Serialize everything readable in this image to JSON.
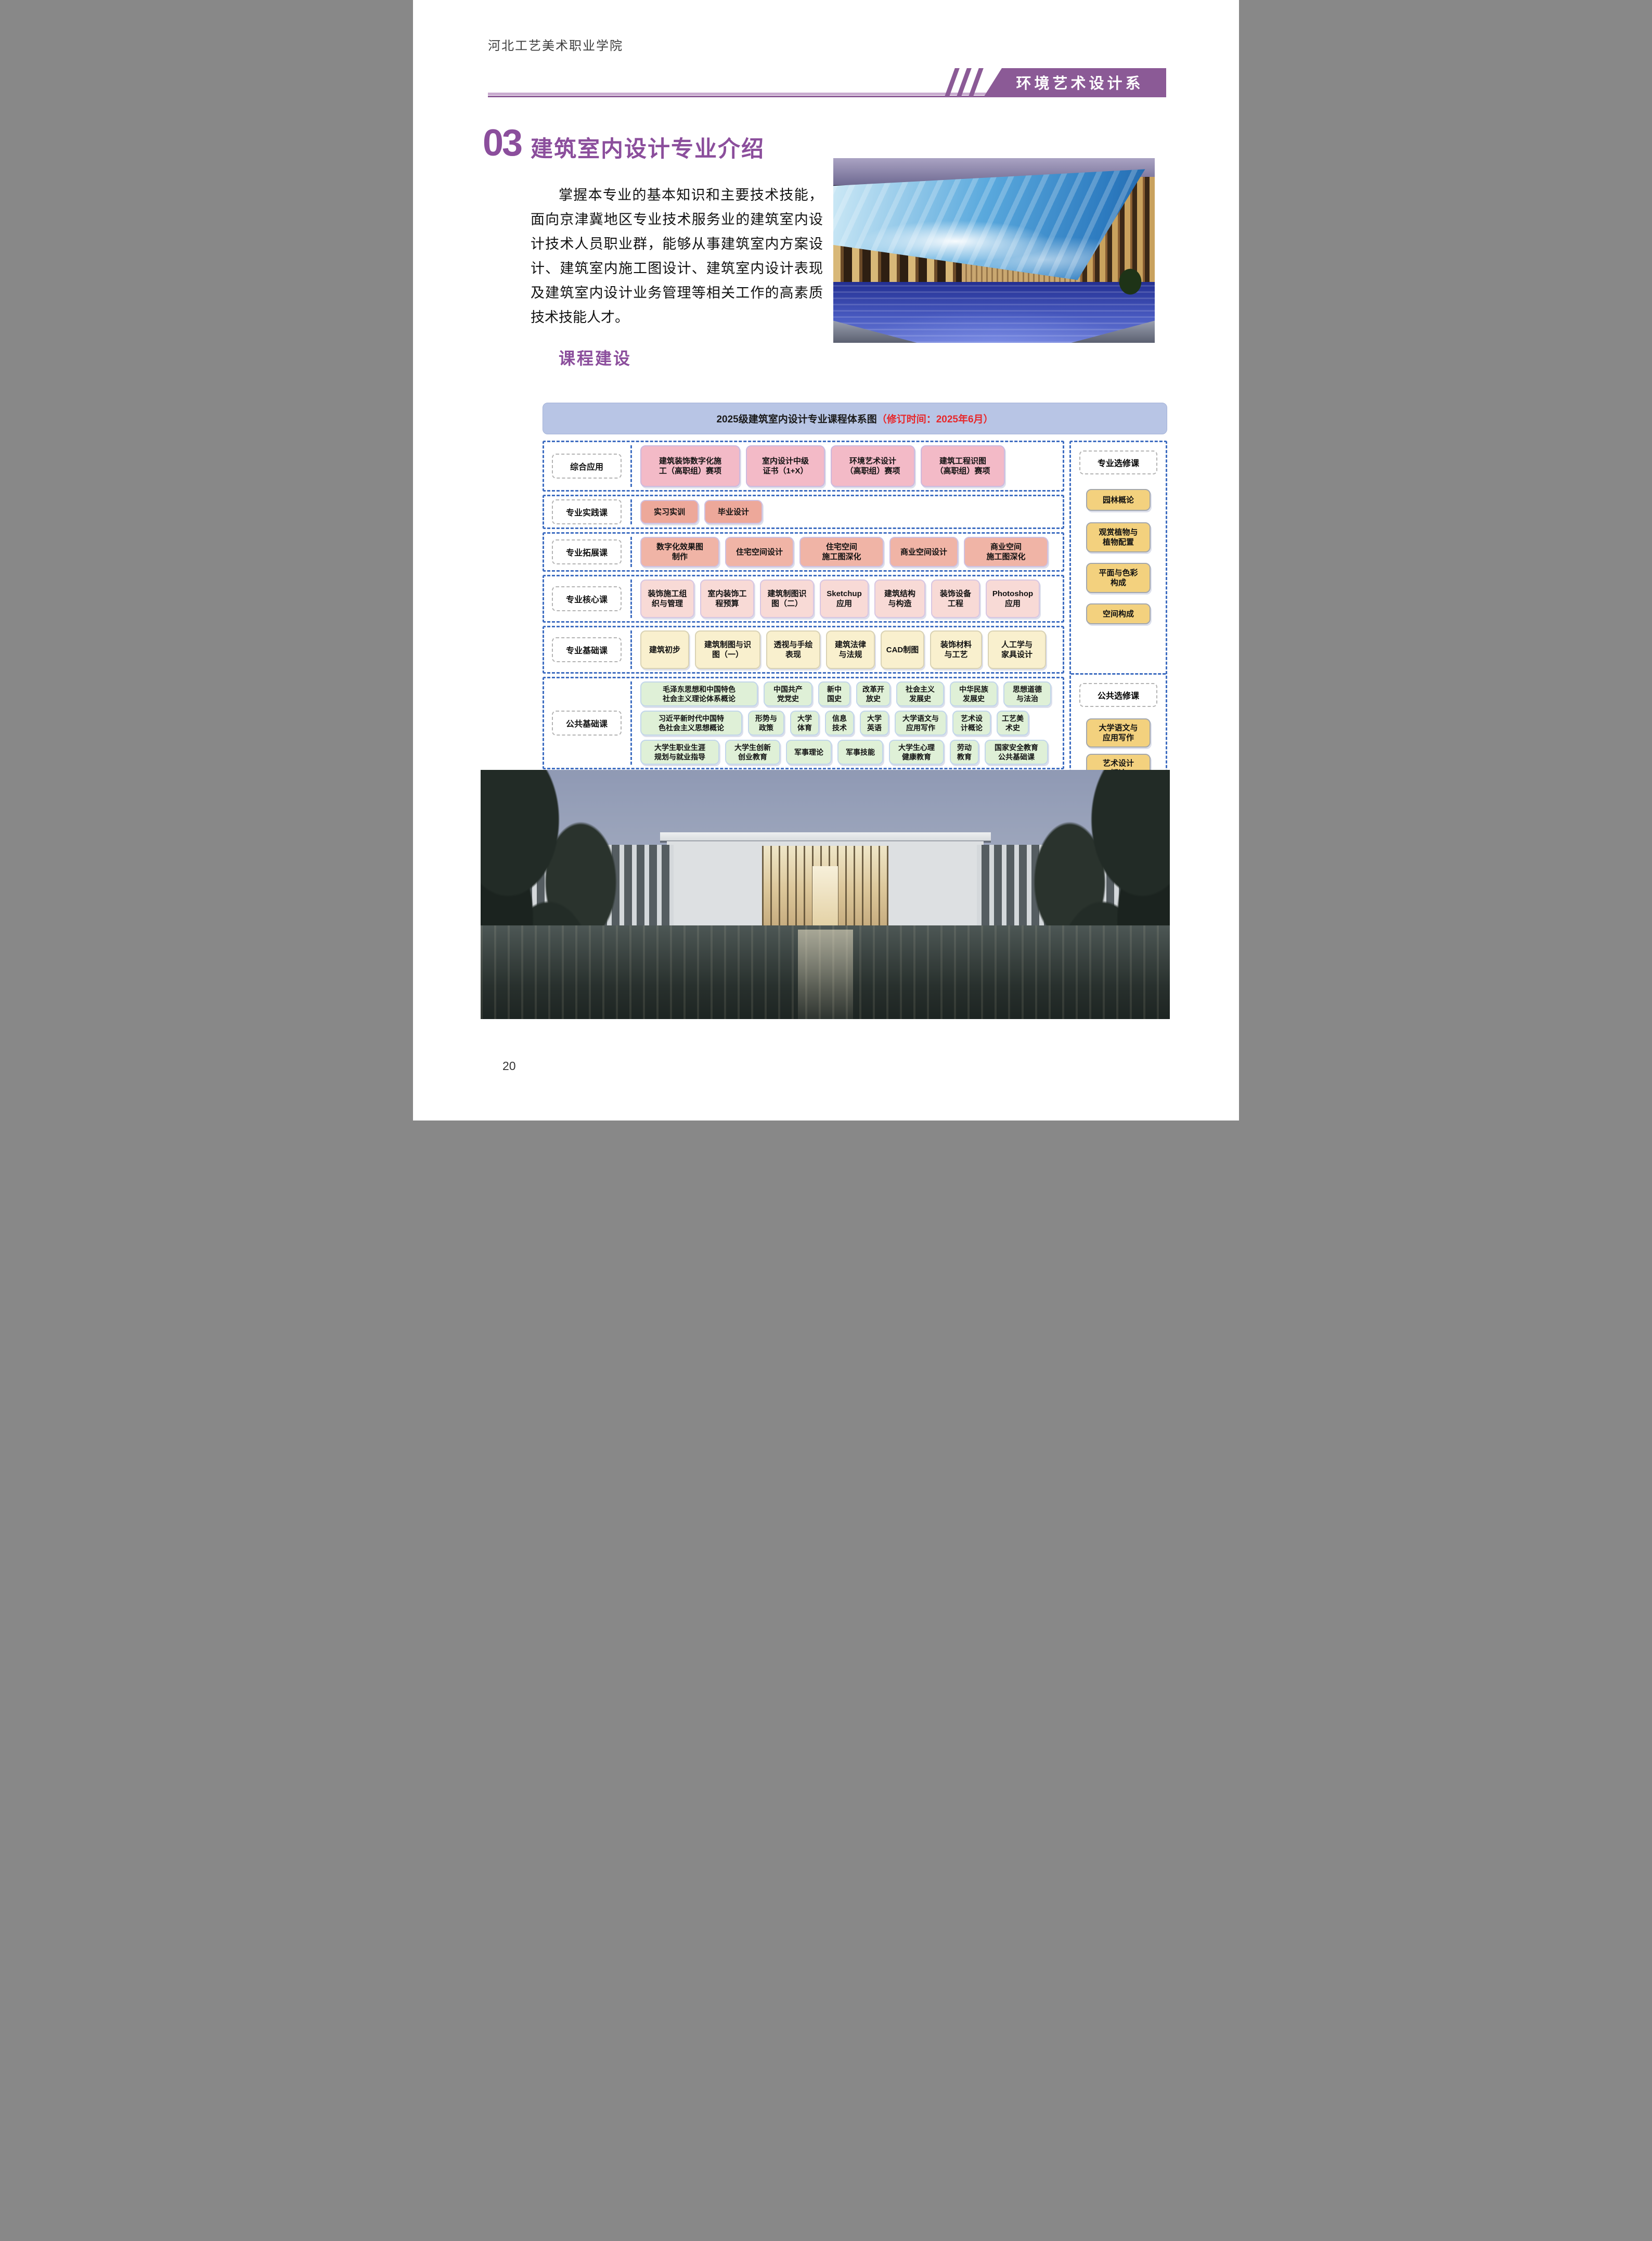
{
  "page": {
    "school_name": "河北工艺美术职业学院",
    "department": "环境艺术设计系",
    "section_number": "03",
    "section_title": "建筑室内设计专业介绍",
    "intro_paragraph": "掌握本专业的基本知识和主要技术技能，面向京津冀地区专业技术服务业的建筑室内设计技术人员职业群，能够从事建筑室内方案设计、建筑室内施工图设计、建筑室内设计表现及建筑室内设计业务管理等相关工作的高素质技术技能人才。",
    "subsection_title": "课程建设",
    "page_number": "20"
  },
  "diagram": {
    "title": "2025级建筑室内设计专业课程体系图",
    "title_note": "（修订时间：2025年6月）",
    "rows": [
      {
        "label": "综合应用",
        "boxes": [
          "建筑装饰数字化施\n工（高职组）赛项",
          "室内设计中级\n证书（1+X）",
          "环境艺术设计\n（高职组）赛项",
          "建筑工程识图\n（高职组）赛项"
        ]
      },
      {
        "label": "专业实践课",
        "boxes": [
          "实习实训",
          "毕业设计"
        ]
      },
      {
        "label": "专业拓展课",
        "boxes": [
          "数字化效果图\n制作",
          "住宅空间设计",
          "住宅空间\n施工图深化",
          "商业空间设计",
          "商业空间\n施工图深化"
        ]
      },
      {
        "label": "专业核心课",
        "boxes": [
          "装饰施工组\n织与管理",
          "室内装饰工\n程预算",
          "建筑制图识\n图（二）",
          "Sketchup\n应用",
          "建筑结构\n与构造",
          "装饰设备\n工程",
          "Photoshop\n应用"
        ]
      },
      {
        "label": "专业基础课",
        "boxes": [
          "建筑初步",
          "建筑制图与识\n图（一）",
          "透视与手绘\n表现",
          "建筑法律\n与法规",
          "CAD制图",
          "装饰材料\n与工艺",
          "人工学与\n家具设计"
        ]
      },
      {
        "label": "公共基础课",
        "box_rows": [
          [
            "毛泽东思想和中国特色\n社会主义理论体系概论",
            "中国共产\n党党史",
            "新中\n国史",
            "改革开\n放史",
            "社会主义\n发展史",
            "中华民族\n发展史",
            "思想道德\n与法治"
          ],
          [
            "习近平新时代中国特\n色社会主义思想概论",
            "形势与\n政策",
            "大学\n体育",
            "信息\n技术",
            "大学\n英语",
            "大学语文与\n应用写作",
            "艺术设\n计概论",
            "工艺美\n术史"
          ],
          [
            "大学生职业生涯\n规划与就业指导",
            "大学生创新\n创业教育",
            "军事理论",
            "军事技能",
            "大学生心理\n健康教育",
            "劳动\n教育",
            "国家安全教育\n公共基础课"
          ]
        ]
      }
    ],
    "right_column": {
      "groups": [
        {
          "label": "专业选修课",
          "boxes": [
            "园林概论",
            "观赏植物与\n植物配置",
            "平面与色彩\n构成",
            "空间构成"
          ]
        },
        {
          "label": "公共选修课",
          "boxes": [
            "大学语文与\n应用写作",
            "艺术设计\n概论",
            "工艺美术史"
          ]
        }
      ]
    }
  },
  "colors": {
    "accent_purple": "#8B5A96",
    "heading_purple": "#8B4E9C",
    "dashed_blue": "#3E6DC1",
    "note_red": "#E8282B",
    "header_band_blue": "#B8C5E5",
    "box_pink": "#F3BAC7",
    "box_salmon": "#EDA89A",
    "box_rose": "#F8DAD6",
    "box_cream": "#F9F0CE",
    "box_green": "#DFF0D7",
    "box_gold": "#F3D17E"
  }
}
